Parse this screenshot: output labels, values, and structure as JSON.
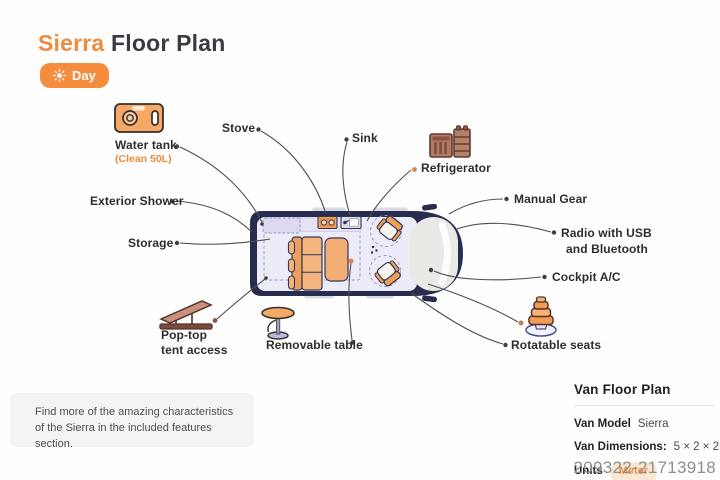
{
  "title": {
    "brand": "Sierra",
    "rest": " Floor Plan"
  },
  "mode_toggle": {
    "label": "Day",
    "icon": "sun-icon"
  },
  "labels": {
    "water_tank": {
      "text": "Water tank",
      "sub": "(Clean 50L)"
    },
    "stove": "Stove",
    "sink": "Sink",
    "refrigerator": "Refrigerator",
    "exterior_shower": "Exterior Shower",
    "storage": "Storage",
    "manual_gear": "Manual Gear",
    "radio": {
      "line1": "Radio with USB",
      "line2": "and Bluetooth"
    },
    "cockpit_ac": "Cockpit A/C",
    "pop_top": {
      "line1": "Pop-top",
      "line2": "tent access"
    },
    "removable_table": "Removable table",
    "rotatable_seats": "Rotatable seats"
  },
  "note": {
    "line1": "Find more of the amazing characteristics",
    "line2": "of the Sierra in the included features section."
  },
  "info_panel": {
    "heading": "Van Floor Plan",
    "rows": [
      {
        "label": "Van Model",
        "value": "Sierra"
      },
      {
        "label": "Van Dimensions:",
        "value": "5 × 2 × 2m"
      },
      {
        "label": "Units",
        "value": "Meter"
      }
    ]
  },
  "watermark": "209322-21713918",
  "colors": {
    "accent_orange": "#ee8b3e",
    "button_orange": "#f68c3e",
    "van_body": "#282c4e",
    "van_interior": "#ecebf8",
    "furniture_orange": "#f4b47e",
    "dashed_purple": "#9b98cb",
    "badge_bg": "#fbe7d2",
    "badge_text": "#e3914c",
    "connector_line": "#4e4e4e"
  }
}
